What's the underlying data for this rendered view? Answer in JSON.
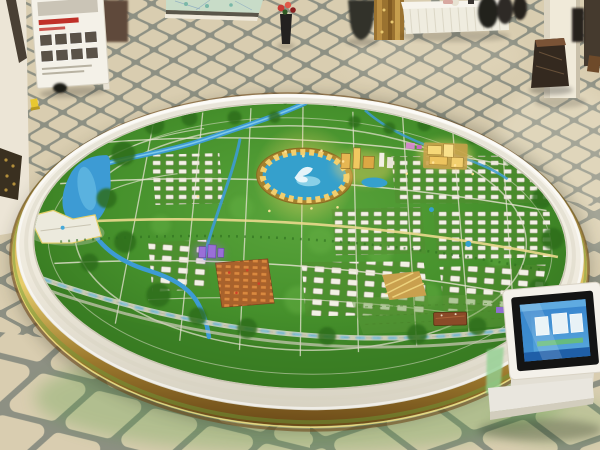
{
  "meta": {
    "type": "photograph",
    "scene": "exhibition hall with a huge circular city master-plan scale model on a round display table",
    "camera": "elevated three-quarter view",
    "lighting": "warm indoor showroom light"
  },
  "palette": {
    "floorTile": "#d9cdb0",
    "floorGrout": "#8d9083",
    "wallWhite": "#ece5d6",
    "rimIvory": "#f3f0e7",
    "goldTrim": "#c9a04a",
    "goldDark": "#7c5a22",
    "modelGreenLight": "#57a33a",
    "modelGreen": "#3c7f26",
    "modelGreenDark": "#2f6a1d",
    "riverBlue": "#3d9bd4",
    "riverLight": "#8fd4ee",
    "roadLight": "#e7e3d3",
    "roadYellow": "#ead98e",
    "landmarkGold": "#e2b350",
    "lagoonBlue": "#35a0cc",
    "purpleLight": "#9a6fd8",
    "orangeRoof": "#c27a38",
    "brickRed": "#8a4a28",
    "flowerRed": "#c83a34",
    "kioskBody": "#e9e6de",
    "kioskBezel": "#141414",
    "screenBlue": "#2f7ec8",
    "screenBlueLight": "#66b2e4",
    "glowGreen": "#4e9a3a"
  },
  "objects": {
    "floor": "beige lattice-pattern marble tile floor with grey grout",
    "display-board": "white easel board with red headline and photo thumbnails",
    "wall-map-panel": "glazed site-plan panel at rear wall",
    "left-column": "white pillar with dark trim",
    "flower-arrangement-left": "red flowers in dark floor vase",
    "flower-arrangement-center": "red flowers in slim black vase",
    "gold-wall-panel": "polished gold patterned wall panel",
    "visitor": "person in dark clothing",
    "banquet-table": "white cloth reception table with pleated skirt",
    "table-figures": "dark silhouettes behind reception table",
    "right-column": "white pillar",
    "marble-pedestal": "dark marble pedestal",
    "right-doorway": "dark doorway at right wall",
    "gilded-object": "gilded ornament at left edge",
    "yellow-floor-item": "small yellow object on floor",
    "dark-floor-item": "small dark object on floor",
    "model-table": "large round display table with white rim and mirrored gold band",
    "model-surface": "green city master-plan scale model",
    "river-lake": "blue river winding into a lake",
    "central-stadium": "oval golden stadium with blue lagoon centerpiece",
    "east-towers": "illuminated tower cluster east of the stadium",
    "northeast-gold-complex": "brightly lit golden building complex",
    "white-districts": "grids of small white model buildings",
    "purple-buildings": "violet-lit buildings",
    "orange-district": "dense orange-roofed district",
    "front-expressway": "curved expressway with blue lights along the front edge",
    "white-campus": "white zigzag campus outlined with yellow light",
    "brown-hall": "brown rectangular hall in the south-east fields",
    "kiosk": "white interactive touchscreen kiosk",
    "kiosk-screen": "blue menu screen with image tiles"
  }
}
